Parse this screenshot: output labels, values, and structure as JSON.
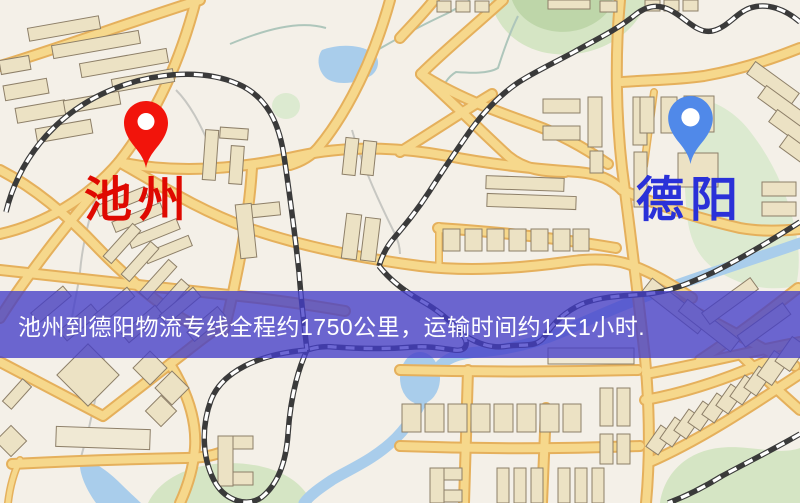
{
  "map": {
    "type": "street-map",
    "colors": {
      "background": "#f4f0e8",
      "road-fill": "#f6d88c",
      "road-casing": "#e5b05c",
      "building-fill": "#ece2c4",
      "building-stroke": "#8d7f68",
      "green-area": "#d5e5c4",
      "water": "#a9cdeb",
      "railway-dark": "#3a3a3a",
      "railway-light": "#ffffff"
    }
  },
  "banner": {
    "text": "池州到德阳物流专线全程约1750公里，运输时间约1天1小时.",
    "distance": "约1750公里",
    "duration": "约1天1小时",
    "background_color": "rgba(68,62,200,0.78)",
    "text_color": "#ffffff"
  },
  "markers": {
    "origin": {
      "name": "池州",
      "pin_color": "#f2140b",
      "label_color": "#df0901",
      "icon": "map-pin-icon"
    },
    "destination": {
      "name": "德阳",
      "pin_color": "#5089e9",
      "label_color": "#2a31d8",
      "icon": "map-pin-icon"
    }
  }
}
